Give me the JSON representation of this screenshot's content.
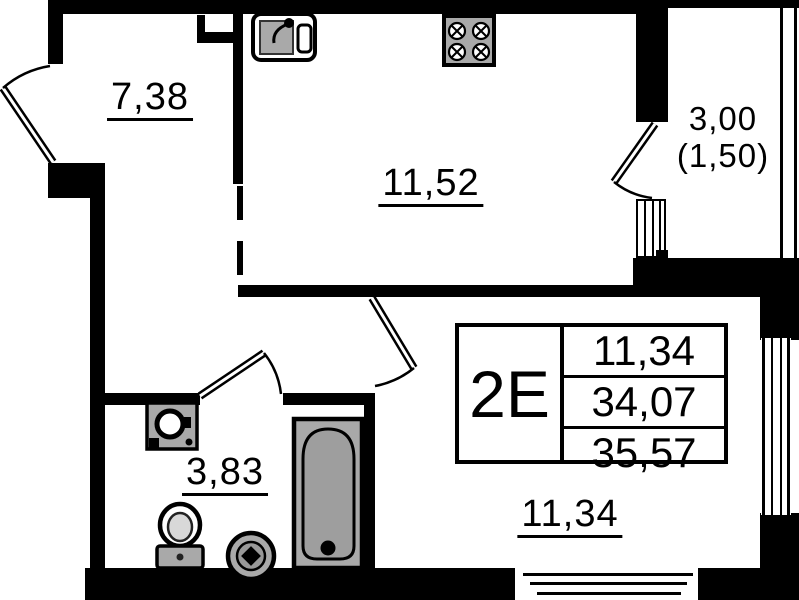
{
  "plan": {
    "rooms": {
      "hallway": {
        "area": "7,38"
      },
      "kitchen": {
        "area": "11,52"
      },
      "balcony": {
        "area": "3,00",
        "area_coefficient": "(1,50)"
      },
      "bathroom": {
        "area": "3,83"
      },
      "living_room": {
        "area": "11,34"
      }
    },
    "info_box": {
      "unit_type": "2Е",
      "living_area": "11,34",
      "apartment_area": "34,07",
      "total_area": "35,57"
    },
    "icons": {
      "kitchen": [
        "sink-icon",
        "stove-icon"
      ],
      "bathroom": [
        "washing-machine-icon",
        "toilet-icon",
        "washbasin-icon",
        "bathtub-icon"
      ]
    },
    "colors": {
      "wall": "#000000",
      "background": "#ffffff",
      "fixture_fill": "#a9a9a9"
    }
  }
}
